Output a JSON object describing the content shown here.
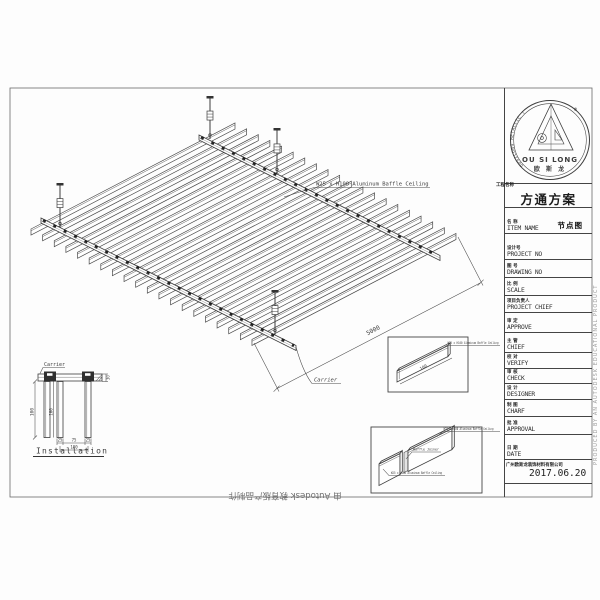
{
  "watermarks": {
    "bottom": "由 Autodesk 教育版产品制作",
    "right": "PRODUCED BY AN AUTODESK EDUCATIONAL PRODUCT"
  },
  "drawing": {
    "baffle_count": 20,
    "baffle_label": "W25 x H100 Aluminum Baffle Ceiling",
    "length_dim": "5000",
    "carrier_label": "Carrier"
  },
  "installation": {
    "title": "Installation",
    "carrier_label": "Carrier",
    "dims": {
      "height_left": "100",
      "height_mid": "100",
      "top_right": "30",
      "bottom_left": "25",
      "bottom_mid": "75",
      "bottom_right": "25",
      "bottom_overall": "100"
    }
  },
  "detail1": {
    "label": "W25 x H100 Aluminum Baffle Ceiling",
    "dim": "100"
  },
  "detail2": {
    "label_top": "W25 x H100 Aluminum Baffle Ceiling",
    "label_mid": "Baffle Joiner",
    "label_bottom": "W25 x H100 Aluminum Baffle Ceiling"
  },
  "titleblock": {
    "logo": {
      "name_en": "OU SI LONG",
      "name_cn": "欧 斯 龙",
      "arc_text": "OUSILONG METALLIC (OSL)",
      "registered": "®"
    },
    "scheme_label": "工程名称",
    "scheme_title": "方通方案",
    "item_value": "节点图",
    "rows": [
      {
        "cn": "名  称",
        "en": "ITEM NAME"
      },
      {
        "cn": "设计号",
        "en": "PROJECT NO"
      },
      {
        "cn": "图  号",
        "en": "DRAWING NO"
      },
      {
        "cn": "比  例",
        "en": "SCALE"
      },
      {
        "cn": "项目负责人",
        "en": "PROJECT CHIEF"
      },
      {
        "cn": "审  定",
        "en": "APPROVE"
      },
      {
        "cn": "主  管",
        "en": "CHIEF"
      },
      {
        "cn": "校  对",
        "en": "VERIFY"
      },
      {
        "cn": "审  核",
        "en": "CHECK"
      },
      {
        "cn": "设  计",
        "en": "DESIGNER"
      },
      {
        "cn": "制  图",
        "en": "CHARF"
      },
      {
        "cn": "批  准",
        "en": "APPROVAL"
      },
      {
        "cn": "日  期",
        "en": "DATE"
      }
    ],
    "company": "广州欧斯龙装饰材料有限公司",
    "date": "2017.06.20"
  }
}
